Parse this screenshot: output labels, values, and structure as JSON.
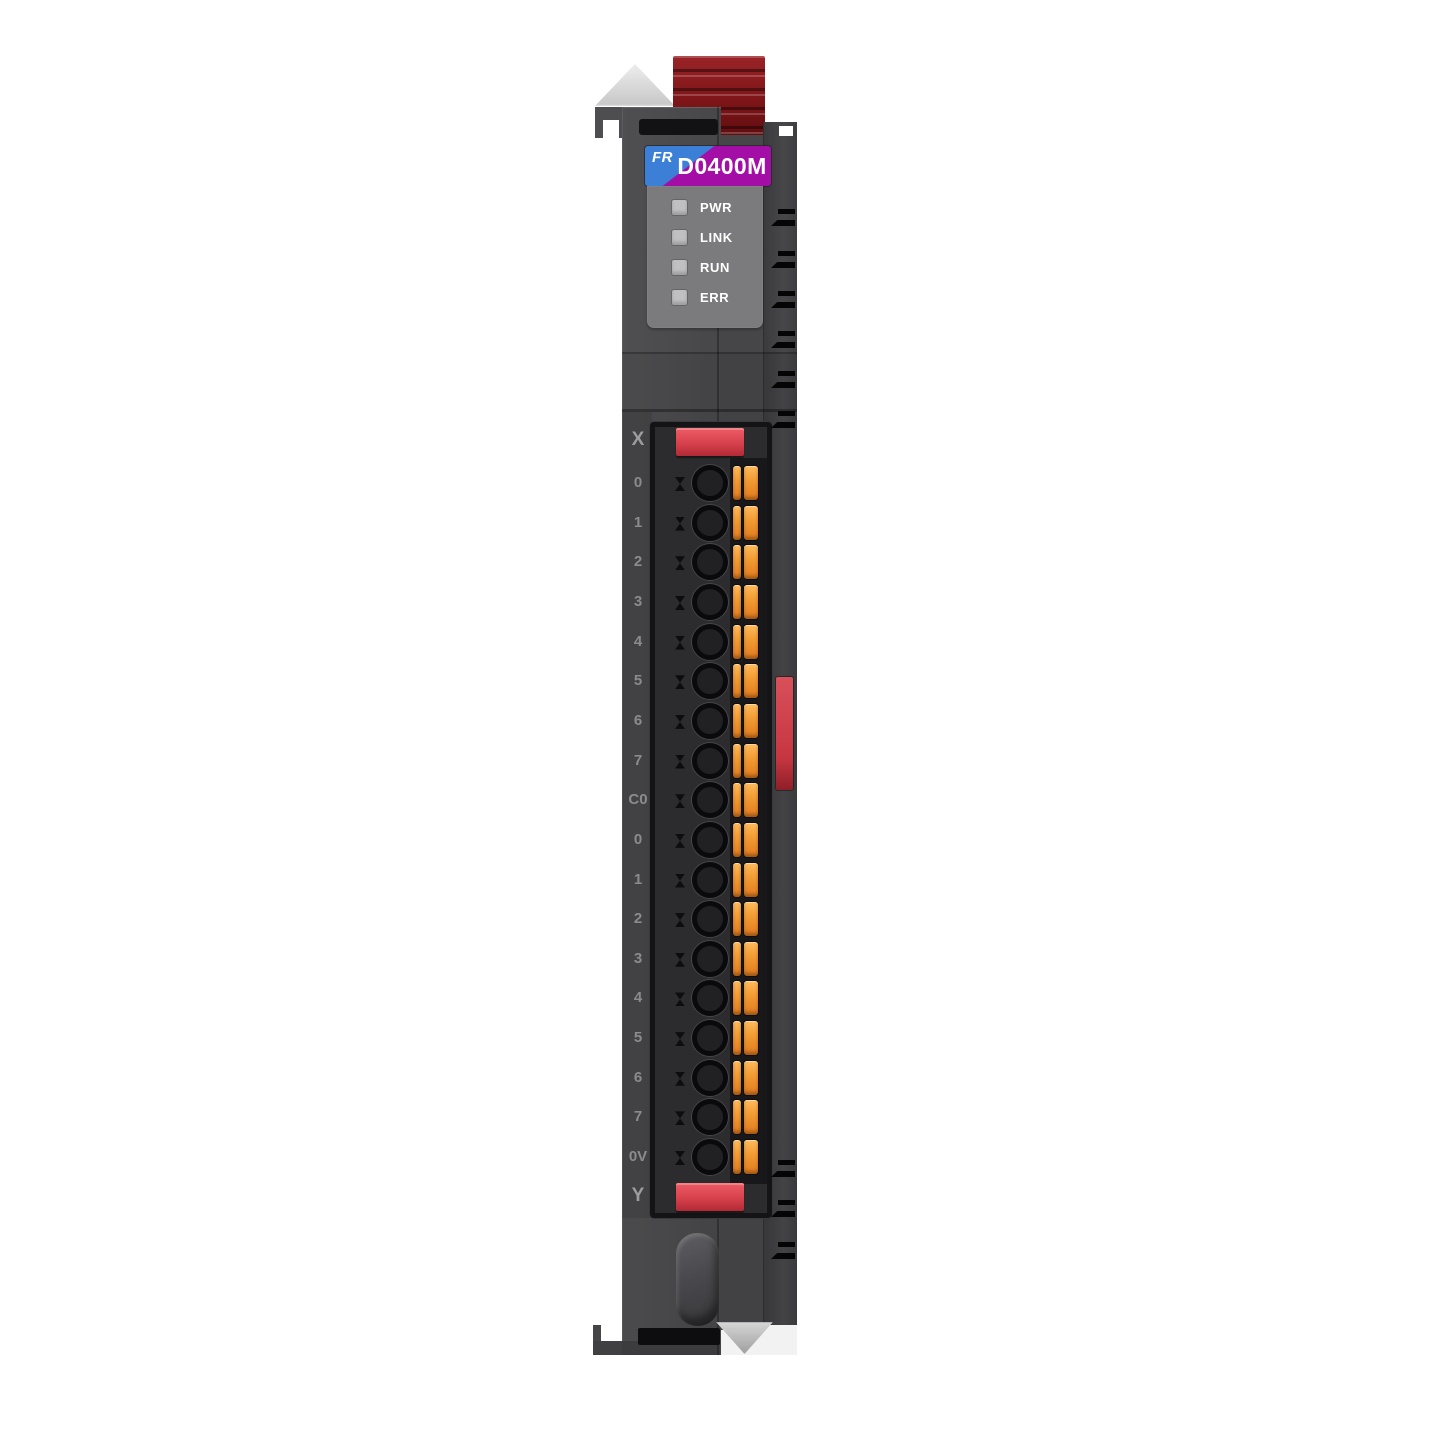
{
  "product": {
    "brand_badge": "FR",
    "model": "D0400M"
  },
  "status_leds": [
    {
      "label": "PWR",
      "state": "off"
    },
    {
      "label": "LINK",
      "state": "off"
    },
    {
      "label": "RUN",
      "state": "off"
    },
    {
      "label": "ERR",
      "state": "off"
    }
  ],
  "terminal_block": {
    "top_section_label": "X",
    "bottom_section_label": "Y",
    "terminal_labels": [
      "0",
      "1",
      "2",
      "3",
      "4",
      "5",
      "6",
      "7",
      "C0",
      "0",
      "1",
      "2",
      "3",
      "4",
      "5",
      "6",
      "7",
      "0V"
    ]
  },
  "colors": {
    "body_gray": "#4b4b4e",
    "panel_gray": "#7b7b7e",
    "led_off_gray": "#c0c0c2",
    "brand_blue": "#3b80d6",
    "model_magenta": "#a30fa6",
    "terminal_clip_red": "#d6414c",
    "din_clip_dark_red": "#7d1518",
    "wire_lever_orange": "#f39d35"
  }
}
